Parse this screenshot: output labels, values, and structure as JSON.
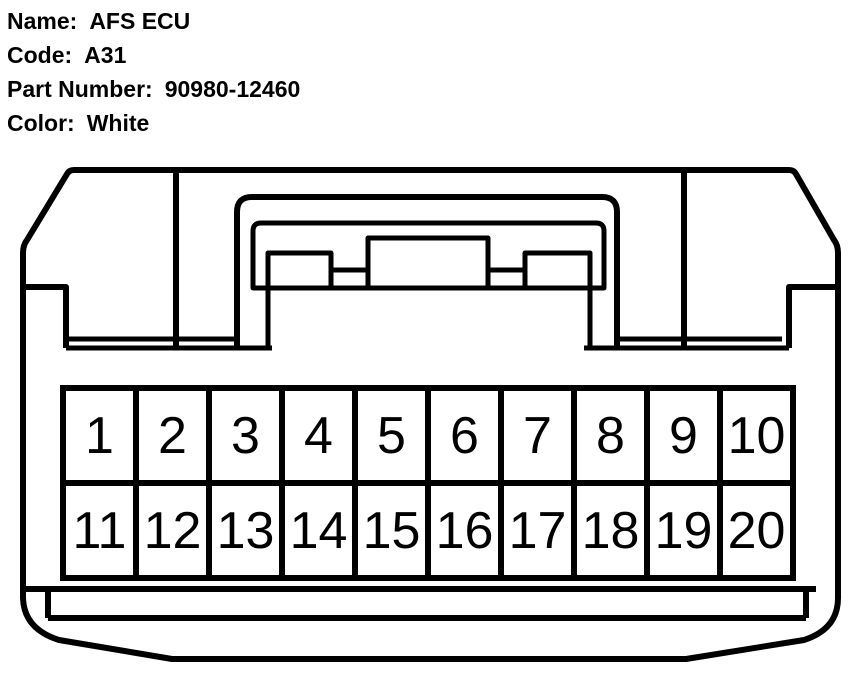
{
  "page": {
    "background_color": "#ffffff",
    "line_color": "#000000",
    "text_color": "#000000"
  },
  "header": {
    "fields": [
      {
        "label": "Name:",
        "value": "AFS ECU"
      },
      {
        "label": "Code:",
        "value": "A31"
      },
      {
        "label": "Part Number:",
        "value": "90980-12460"
      },
      {
        "label": "Color:",
        "value": "White"
      }
    ]
  },
  "connector": {
    "rows": 2,
    "columns": 10,
    "pin_rows": [
      {
        "pins": [
          "1",
          "2",
          "3",
          "4",
          "5",
          "6",
          "7",
          "8",
          "9",
          "10"
        ]
      },
      {
        "pins": [
          "11",
          "12",
          "13",
          "14",
          "15",
          "16",
          "17",
          "18",
          "19",
          "20"
        ]
      }
    ]
  }
}
